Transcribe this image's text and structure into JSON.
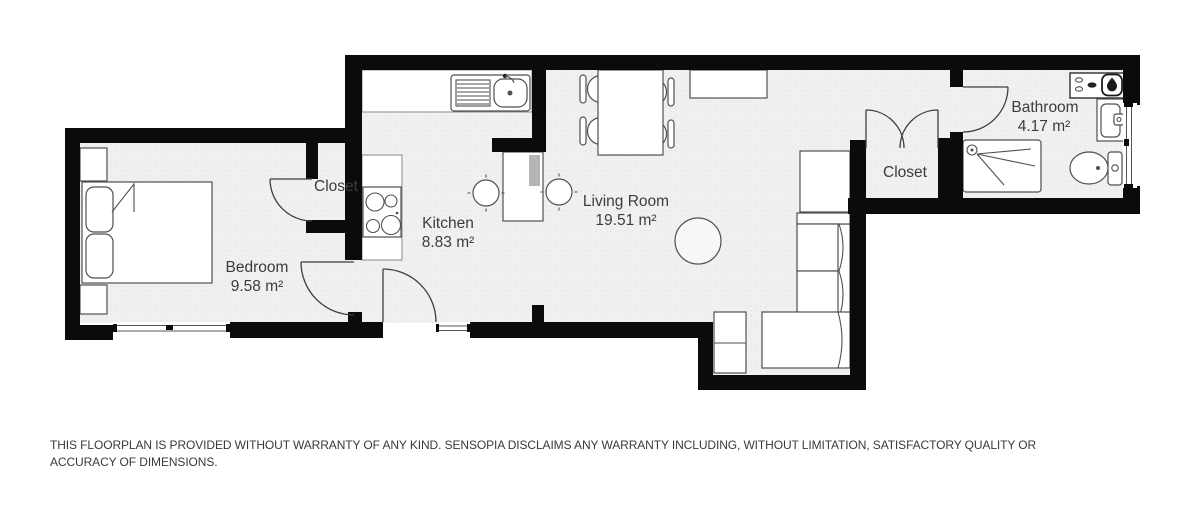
{
  "plan": {
    "rooms": {
      "bedroom": {
        "name": "Bedroom",
        "area": "9.58 m²"
      },
      "bedroom_closet": {
        "name": "Closet"
      },
      "kitchen": {
        "name": "Kitchen",
        "area": "8.83 m²"
      },
      "living_room": {
        "name": "Living Room",
        "area": "19.51 m²"
      },
      "hall_closet": {
        "name": "Closet"
      },
      "bathroom": {
        "name": "Bathroom",
        "area": "4.17 m²"
      }
    },
    "icons": {
      "flame_icon": "gas-boiler-flame",
      "shower_head_icon": "shower-head",
      "sink_icon": "kitchen-sink"
    },
    "colors": {
      "wall": "#0b0b0b",
      "floor": "#f0f0f0",
      "furniture_outline": "#4f4f4f",
      "label_text": "#3c3c3c",
      "background": "#ffffff"
    }
  },
  "footer": {
    "disclaimer": "THIS FLOORPLAN IS PROVIDED WITHOUT WARRANTY OF ANY KIND. SENSOPIA DISCLAIMS ANY WARRANTY INCLUDING, WITHOUT LIMITATION, SATISFACTORY QUALITY OR ACCURACY OF DIMENSIONS."
  }
}
